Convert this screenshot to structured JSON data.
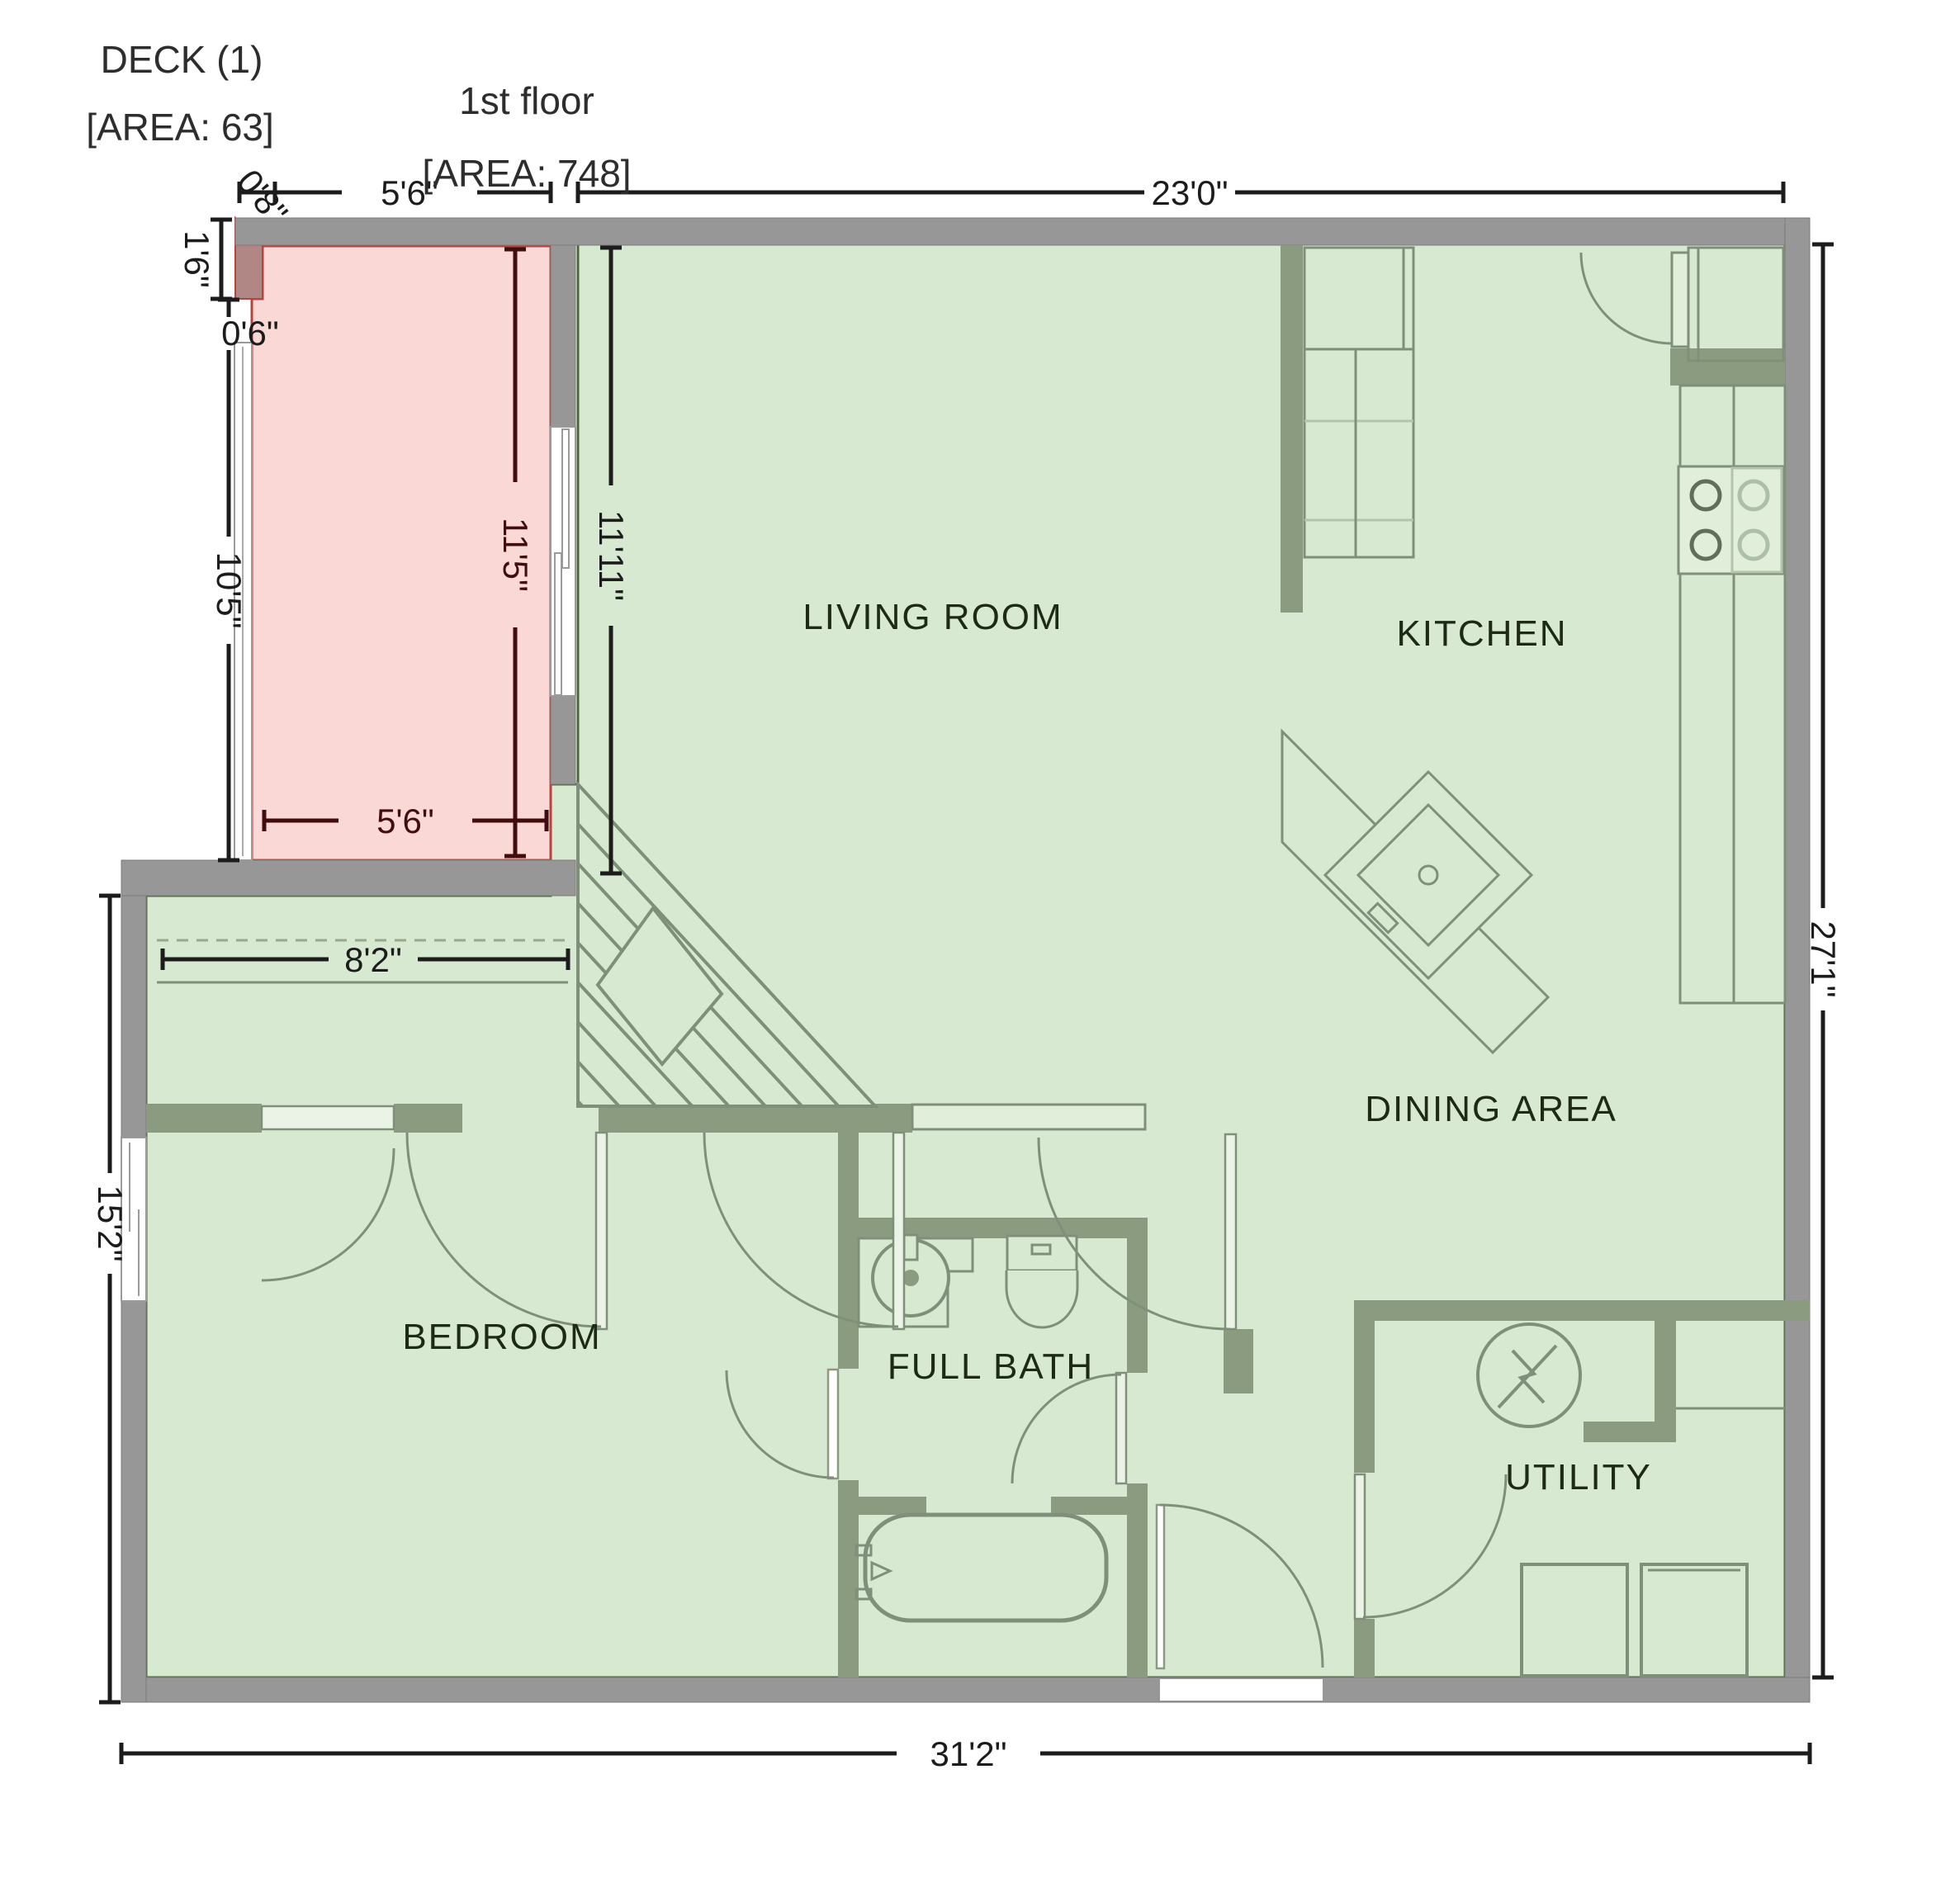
{
  "header": {
    "deck_title": "DECK (1)",
    "deck_area": "[AREA: 63]",
    "floor_title": "1st floor",
    "floor_area": "[AREA: 748]"
  },
  "rooms": {
    "living_room": "LIVING ROOM",
    "kitchen": "KITCHEN",
    "dining_area": "DINING AREA",
    "bedroom": "BEDROOM",
    "full_bath": "FULL BATH",
    "utility": "UTILITY"
  },
  "dimensions": {
    "deck_top_offset": "0'8\"",
    "deck_top_width": "5'6\"",
    "main_top_width": "23'0\"",
    "deck_wall_stub": "1'6\"",
    "deck_left_offset": "0'6\"",
    "deck_left_height": "10'5\"",
    "deck_inner_height": "11'5\"",
    "living_room_height": "11'11\"",
    "deck_bottom_width": "5'6\"",
    "closet_width": "8'2\"",
    "left_side_height": "15'2\"",
    "bottom_width": "31'2\"",
    "right_side_height": "27'1\""
  },
  "colors": {
    "room_fill": "#d8e9d2",
    "deck_fill": "#f9d8d6",
    "deck_border": "#b7433e",
    "deck_corner": "#b18786",
    "outer_wall": "#979797",
    "inner_wall": "#8b9b80",
    "fixture_stroke": "#7f907a",
    "dim_line": "#1c1c1c",
    "deck_dim_line": "#420d0d",
    "room_label_text": "#1d2a16",
    "title_text": "#2d2d2d"
  }
}
